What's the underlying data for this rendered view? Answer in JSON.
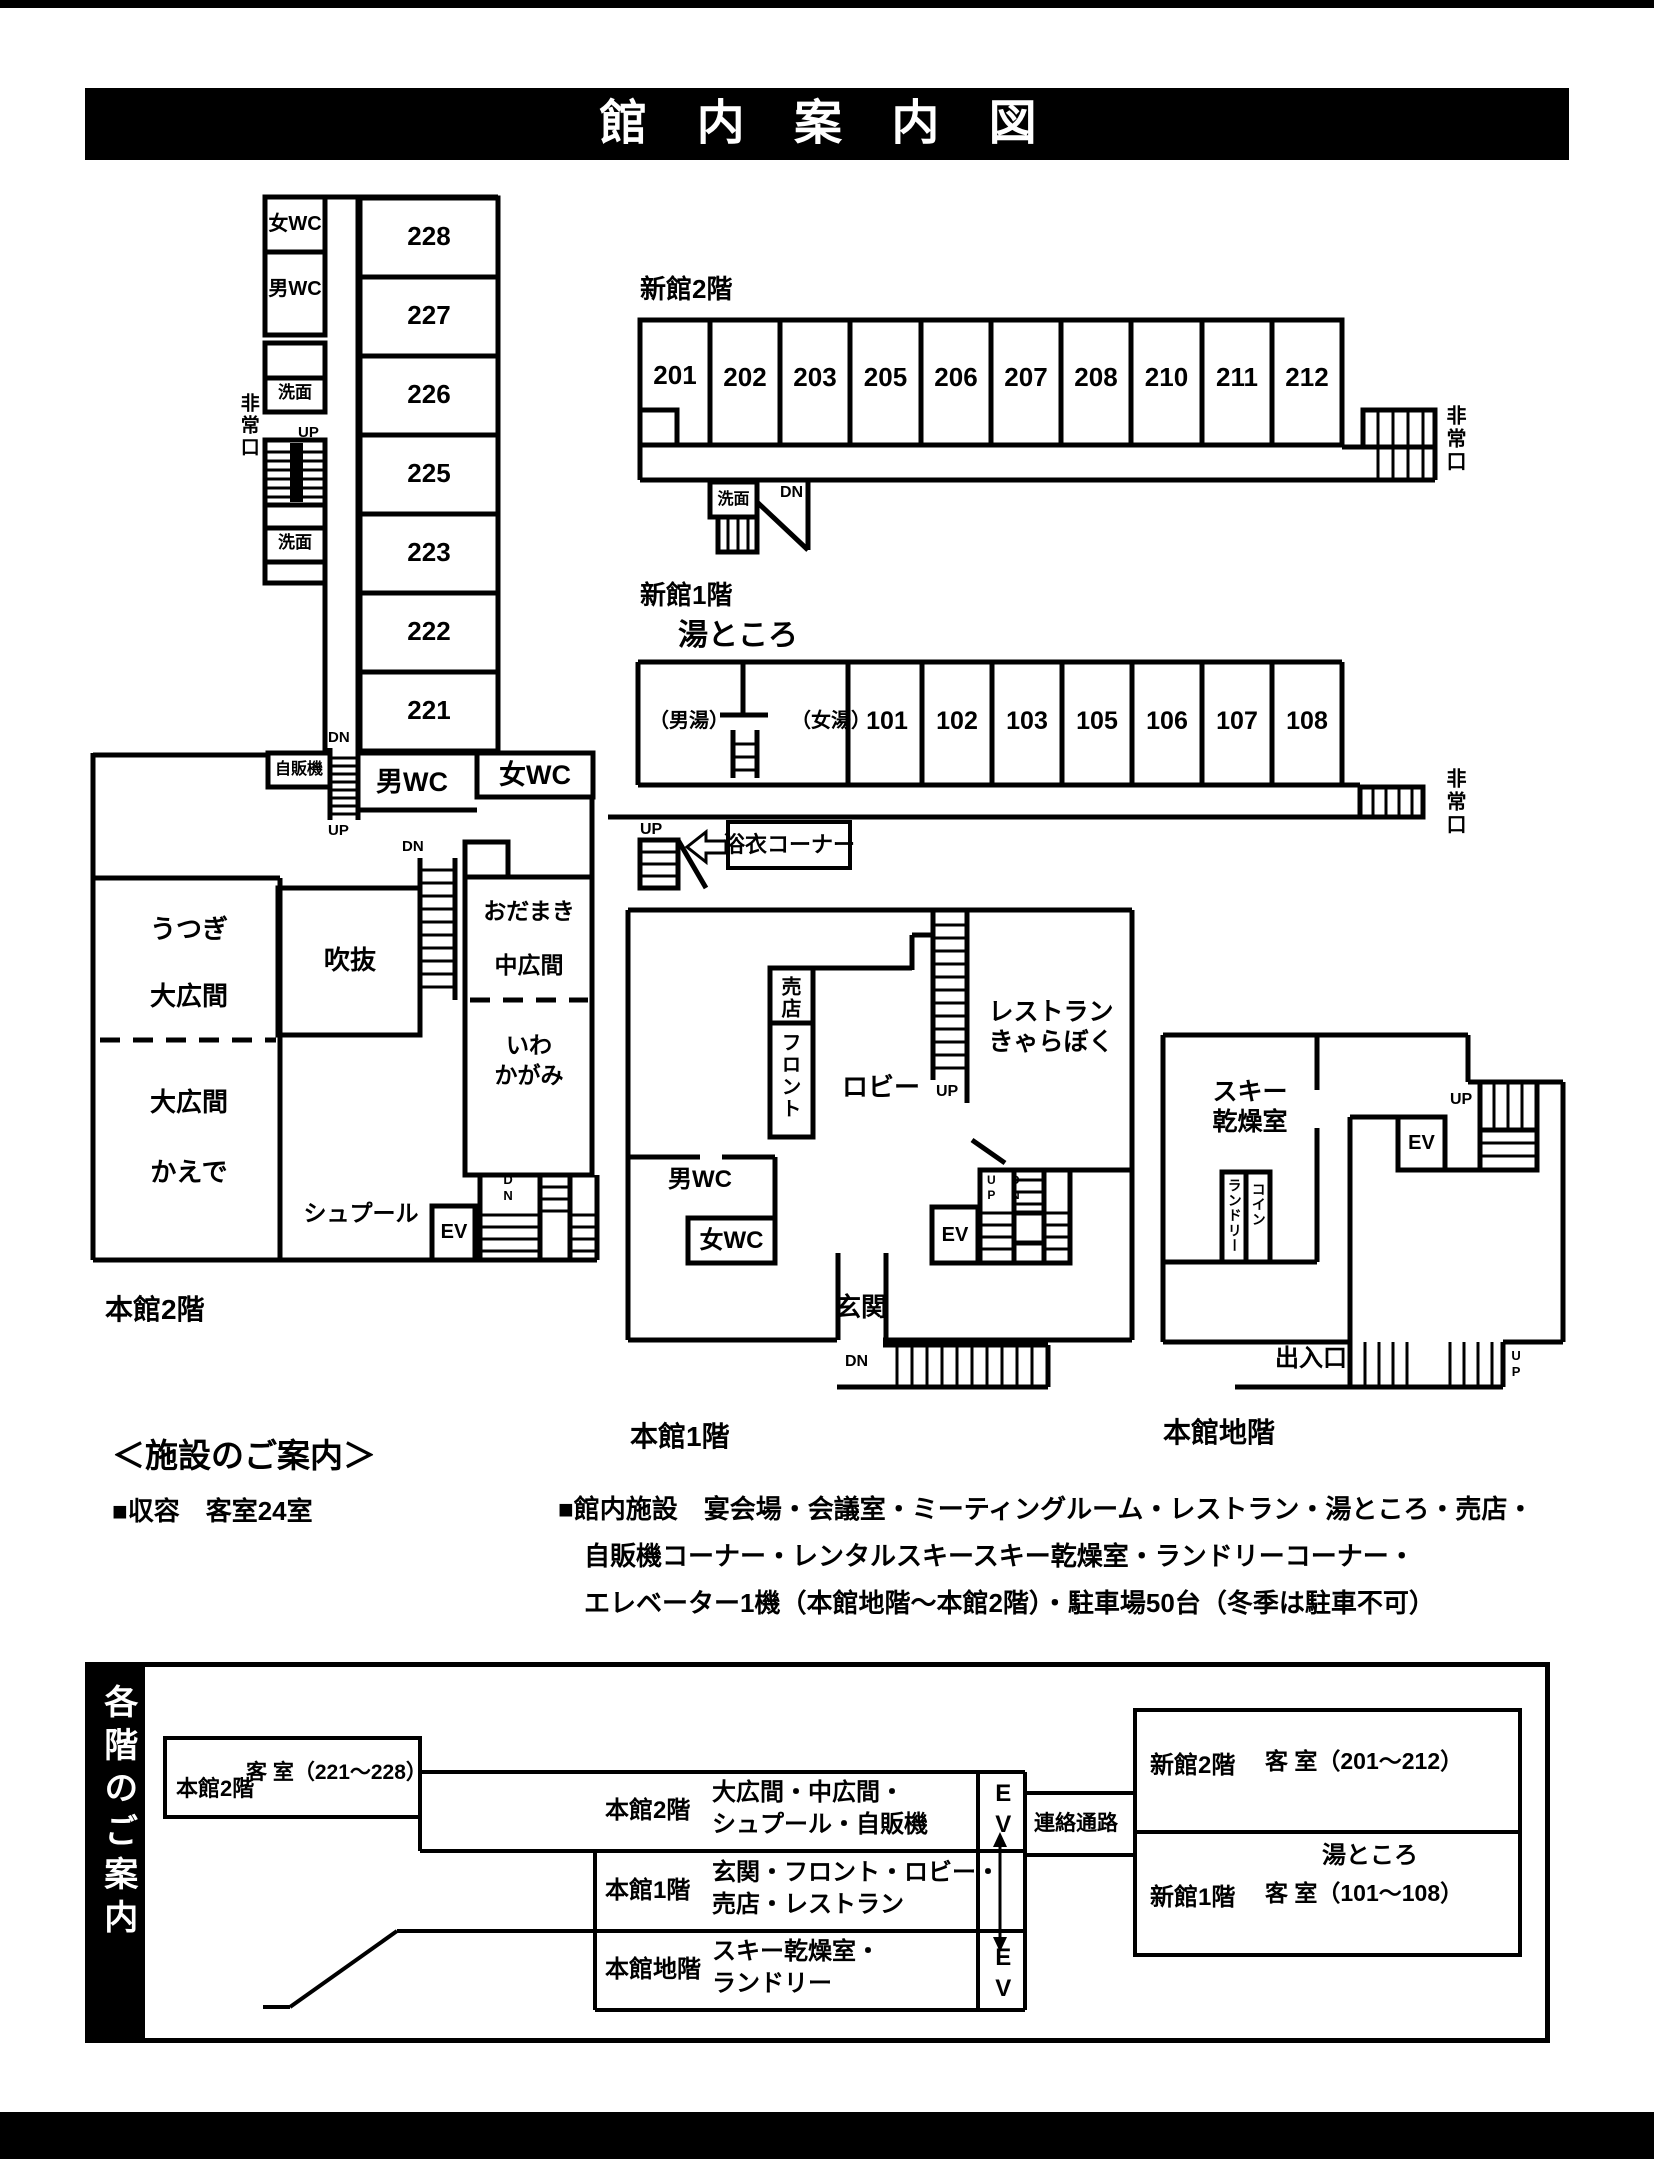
{
  "page": {
    "title": "館 内 案 内 図"
  },
  "plans": {
    "honkan2f": {
      "caption": "本館2階",
      "rooms": [
        "228",
        "227",
        "226",
        "225",
        "223",
        "222",
        "221"
      ],
      "womens_wc": "女WC",
      "mens_wc": "男WC",
      "washroom1": "洗面",
      "washroom2": "洗面",
      "emergency_exit": "非常口",
      "stair_up1": "UP",
      "stair_dn1": "DN",
      "stair_up2": "UP",
      "vending": "自販機",
      "mens_wc2": "男WC",
      "womens_wc2": "女WC",
      "utsugi_line1": "うつぎ",
      "utsugi_line2": "大広間",
      "kaede_line1": "大広間",
      "kaede_line2": "かえで",
      "atrium": "吹抜",
      "stair_dn2": "DN",
      "odamaki_line1": "おだまき",
      "odamaki_line2": "中広間",
      "iwakagami_line1": "いわ",
      "iwakagami_line2": "かがみ",
      "stair_dn3": "DN",
      "elevator": "EV",
      "spur": "シュプール"
    },
    "shinkan2f": {
      "caption": "新館2階",
      "rooms": [
        "201",
        "202",
        "203",
        "205",
        "206",
        "207",
        "208",
        "210",
        "211",
        "212"
      ],
      "washroom": "洗面",
      "stair_dn": "DN",
      "emergency_exit": "非常口"
    },
    "shinkan1f": {
      "caption": "新館1階",
      "bath_title": "湯ところ",
      "bath_mens": "（男湯）",
      "bath_womens": "（女湯）",
      "rooms": [
        "101",
        "102",
        "103",
        "105",
        "106",
        "107",
        "108"
      ],
      "stair_up": "UP",
      "yukata_corner": "浴衣コーナー",
      "emergency_exit": "非常口"
    },
    "honkan1f": {
      "caption": "本館1階",
      "shop": "売店",
      "front_desk": "フロント",
      "lobby": "ロビー",
      "restaurant_line1": "レストラン",
      "restaurant_line2": "きゃらぼく",
      "stair_up1": "UP",
      "mens_wc": "男WC",
      "womens_wc": "女WC",
      "elevator": "EV",
      "stair_up2": "UP",
      "stair_dn2": "DN",
      "entrance": "玄関",
      "stair_dn1": "DN"
    },
    "honkanb1": {
      "caption": "本館地階",
      "ski_line1": "スキー",
      "ski_line2": "乾燥室",
      "elevator": "EV",
      "stair_up1": "UP",
      "laundry": "ランドリー",
      "coin": "コイン",
      "doorway": "出入口",
      "stair_up2": "UP"
    }
  },
  "facility_info": {
    "heading": "＜施設のご案内＞",
    "capacity": "■収容　客室24室",
    "facilities_line1": "■館内施設　宴会場・会議室・ミーティングルーム・レストラン・湯ところ・売店・",
    "facilities_line2": "自販機コーナー・レンタルスキースキー乾燥室・ランドリーコーナー・",
    "facilities_line3": "エレベーター1機（本館地階～本館2階）・駐車場50台（冬季は駐車不可）"
  },
  "floor_guide": {
    "sidebar_title": "各階のご案内",
    "honkan2f_rooms": {
      "floor": "本館2階",
      "desc": "客 室（221～228）"
    },
    "rows": [
      {
        "floor": "本館2階",
        "desc1": "大広間・中広間・",
        "desc2": "シュプール・自販機"
      },
      {
        "floor": "本館1階",
        "desc1": "玄関・フロント・ロビー・",
        "desc2": "売店・レストラン"
      },
      {
        "floor": "本館地階",
        "desc1": "スキー乾燥室・",
        "desc2": "ランドリー"
      }
    ],
    "ev_top": "EV",
    "ev_bottom": "EV",
    "corridor": "連絡通路",
    "shinkan2f": {
      "floor": "新館2階",
      "desc": "客 室（201～212）"
    },
    "shinkan1f": {
      "floor": "新館1階",
      "desc_top": "湯ところ",
      "desc": "客 室（101～108）"
    }
  }
}
